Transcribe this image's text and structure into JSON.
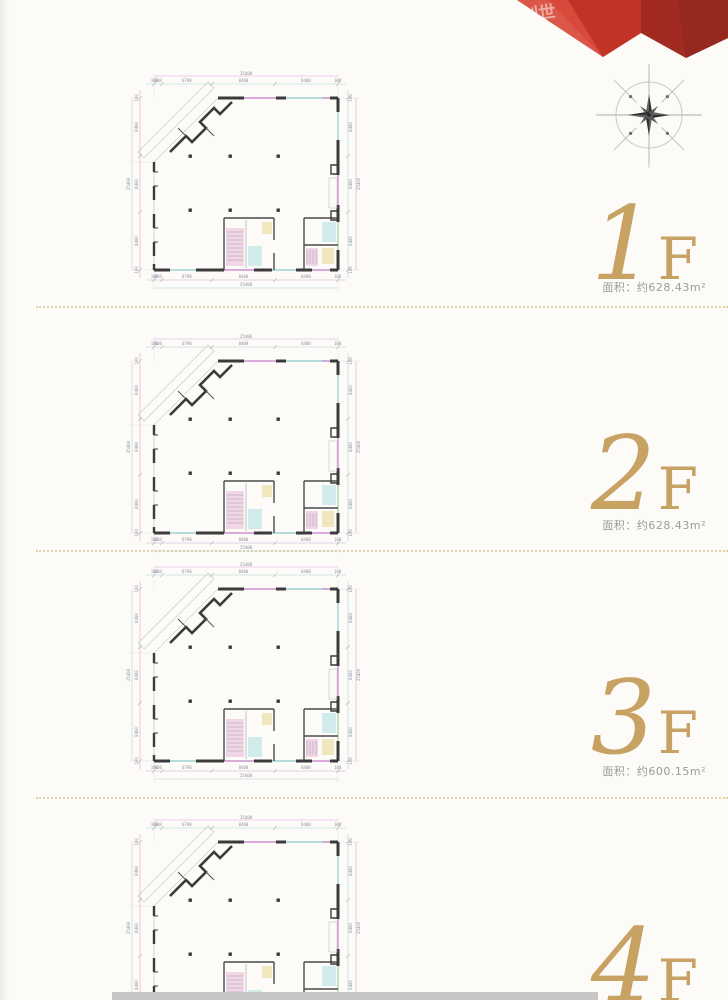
{
  "page": {
    "background": "#fcfbf8"
  },
  "watermark": {
    "text": "创世",
    "subtext": "zhuy"
  },
  "banner": {
    "color_primary": "#cf3a2c",
    "color_mid": "#c23327",
    "color_dark": "#a12b20"
  },
  "accent": {
    "gold": "#c8a263",
    "separator_dotted": "#dcc9a4"
  },
  "floors": [
    {
      "number": "1",
      "suffix": "F",
      "area_label": "面积：约628.43m²"
    },
    {
      "number": "2",
      "suffix": "F",
      "area_label": "面积：约628.43m²"
    },
    {
      "number": "3",
      "suffix": "F",
      "area_label": "面积：约600.15m²"
    },
    {
      "number": "4",
      "suffix": "F"
    }
  ],
  "floor_plan": {
    "top_total": "25400",
    "top_segments": [
      "100",
      "910",
      "6790",
      "8400",
      "8400",
      "100"
    ],
    "bottom_segments": [
      "100",
      "910",
      "6790",
      "8400",
      "8400",
      "100"
    ],
    "bottom_total": "25400",
    "left_total": "25400",
    "left_segments": [
      "100",
      "8400",
      "8400",
      "8400",
      "100"
    ],
    "right_total": "25400",
    "right_segments": [
      "100",
      "8400",
      "8400",
      "8400",
      "100"
    ]
  }
}
